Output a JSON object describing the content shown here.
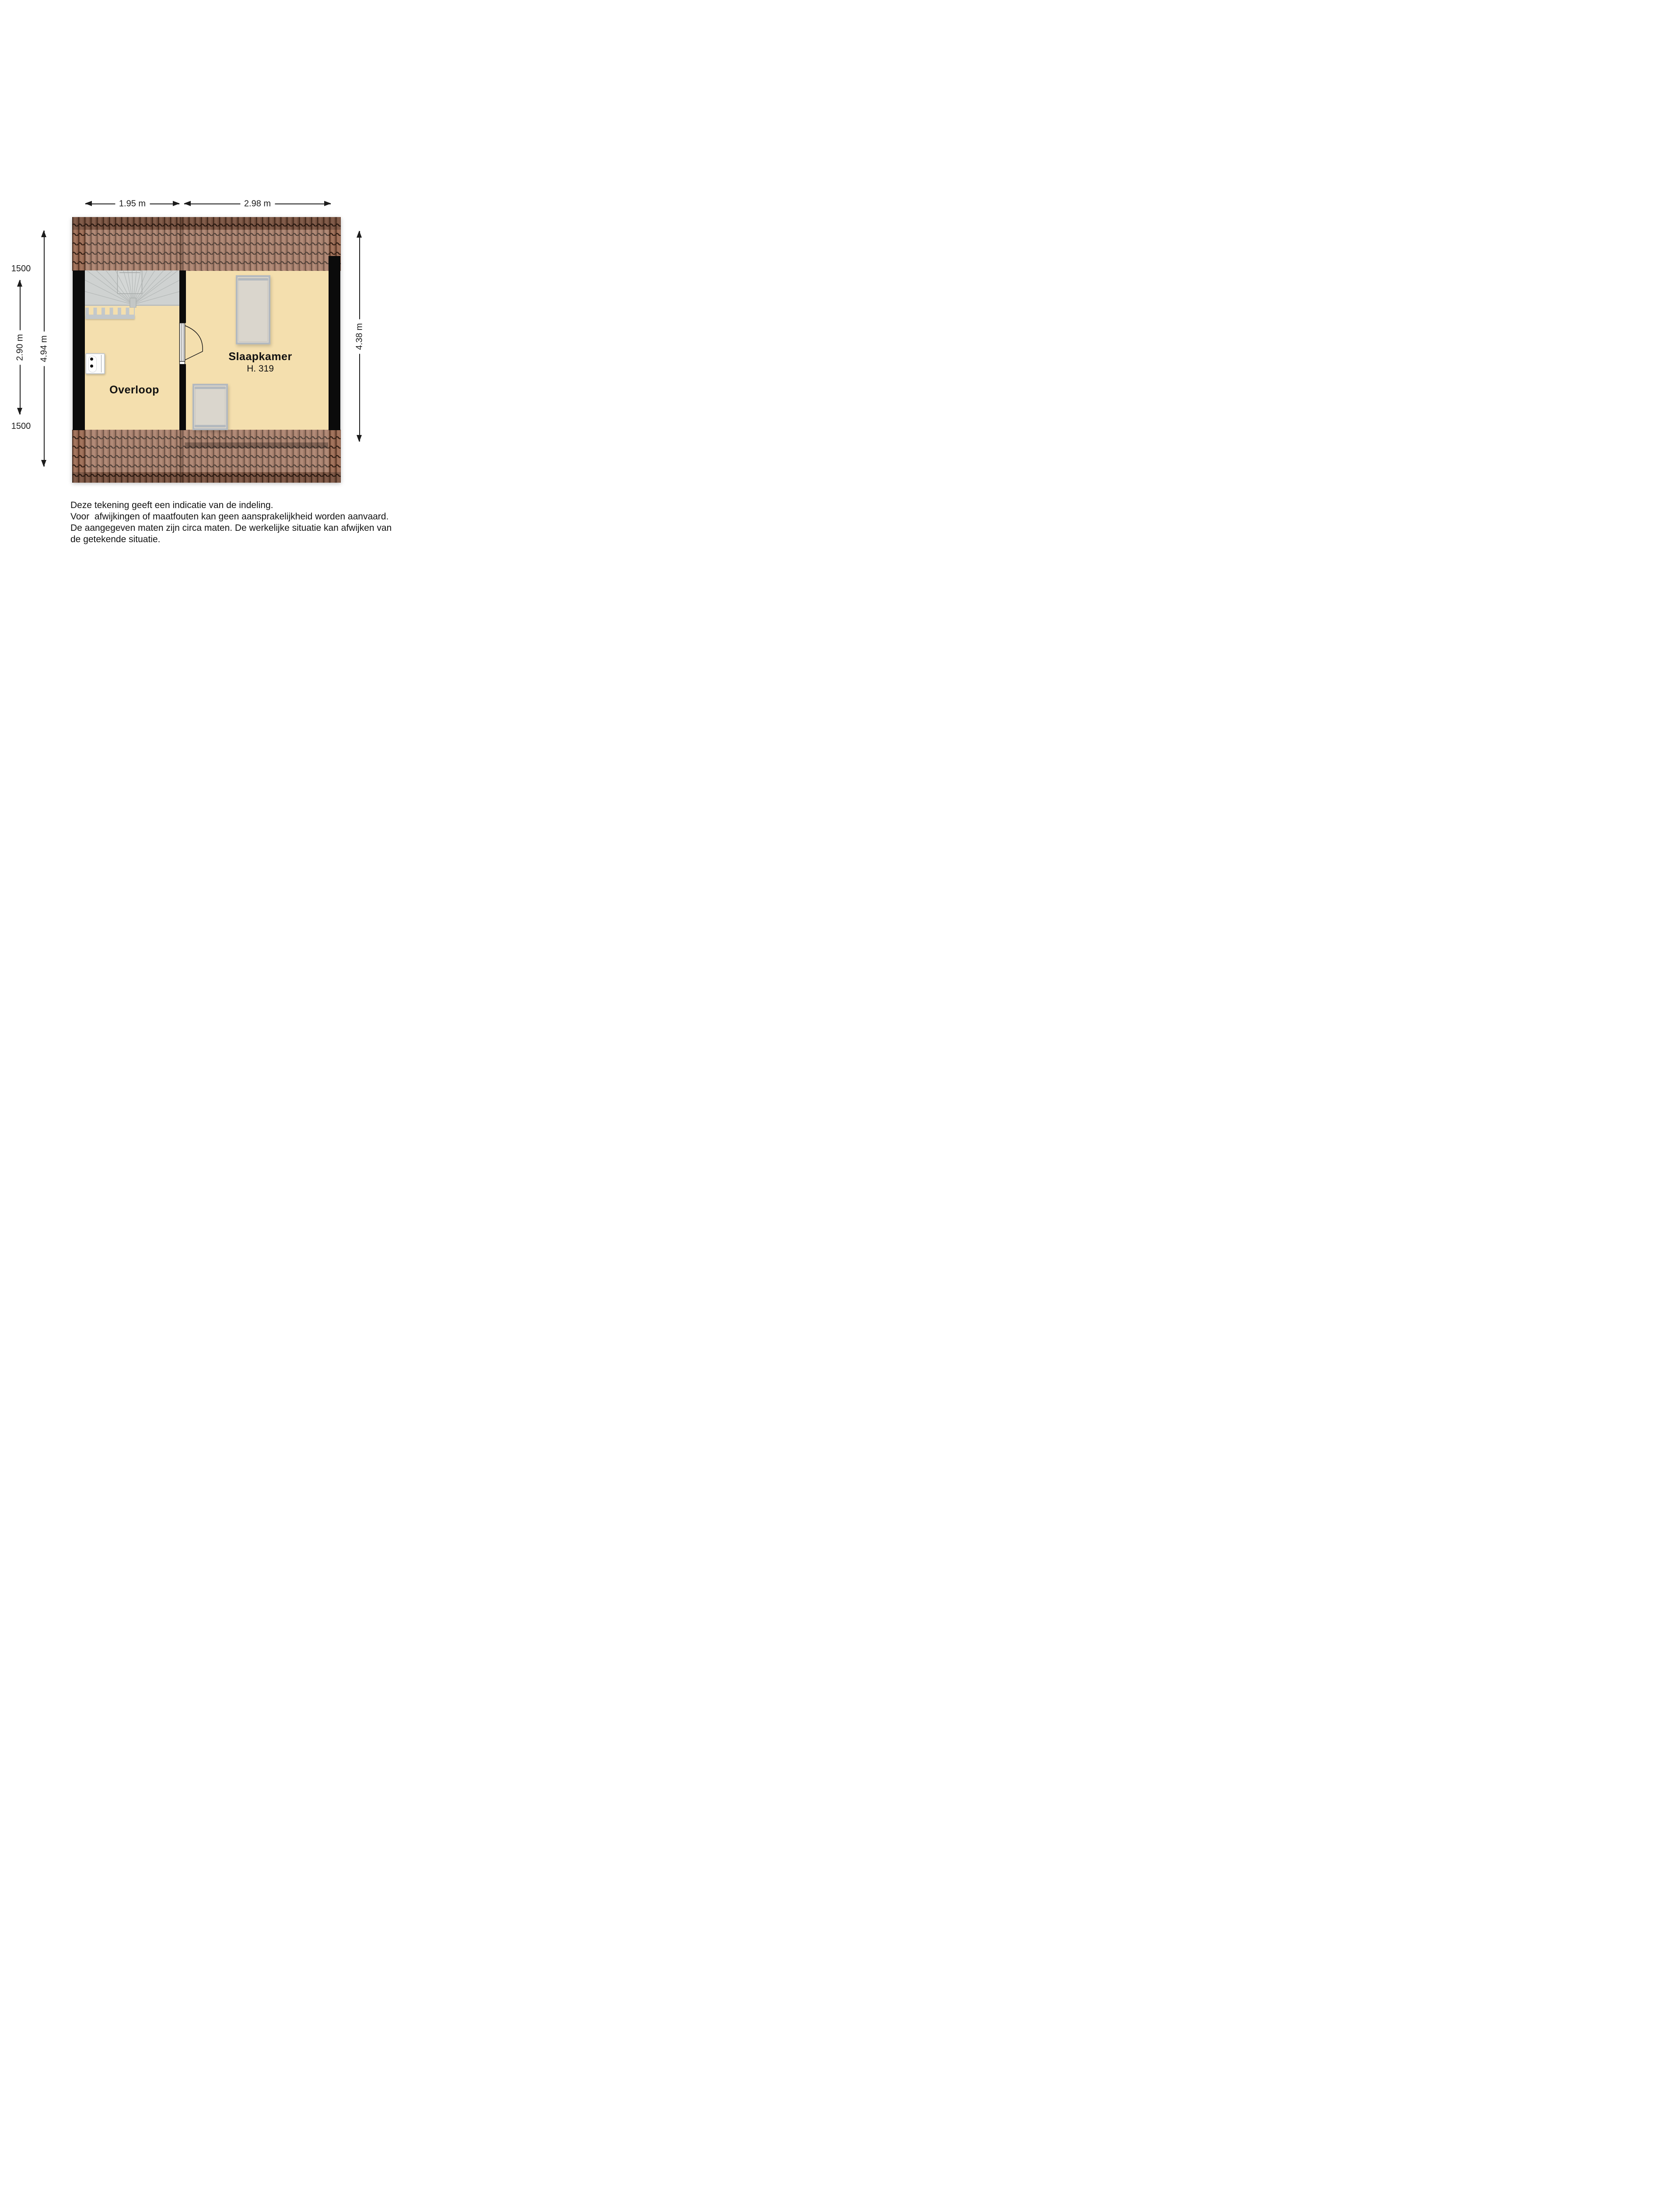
{
  "rooms": {
    "overloop": {
      "label": "Overloop"
    },
    "slaapkamer": {
      "label": "Slaapkamer",
      "ceiling_height": "H. 319"
    }
  },
  "dimensions": {
    "top_left_width": "1.95 m",
    "top_right_width": "2.98 m",
    "left_inner_height": "2.90 m",
    "left_total_height": "4.94 m",
    "left_knee_wall_top": "1500",
    "left_knee_wall_bottom": "1500",
    "right_height": "4.38 m"
  },
  "disclaimer": {
    "lines": [
      "Deze tekening geeft een indicatie van de indeling.",
      "Voor  afwijkingen of maatfouten kan geen aansprakelijkheid worden aanvaard.",
      "De aangegeven maten zijn circa maten. De werkelijke situatie kan afwijken van",
      "de getekende situatie."
    ]
  },
  "colors": {
    "floor": "#f4dfae",
    "wall": "#0b0b0b",
    "tile_base": "#8e614c",
    "tile_highlight": "#a87b63",
    "tile_line": "#331f15",
    "stairs": "#cfd2d1",
    "fixture_frame": "#b3b9bf",
    "fixture_fill": "#dad6cd",
    "dimension_ink": "#1c1c1c"
  }
}
